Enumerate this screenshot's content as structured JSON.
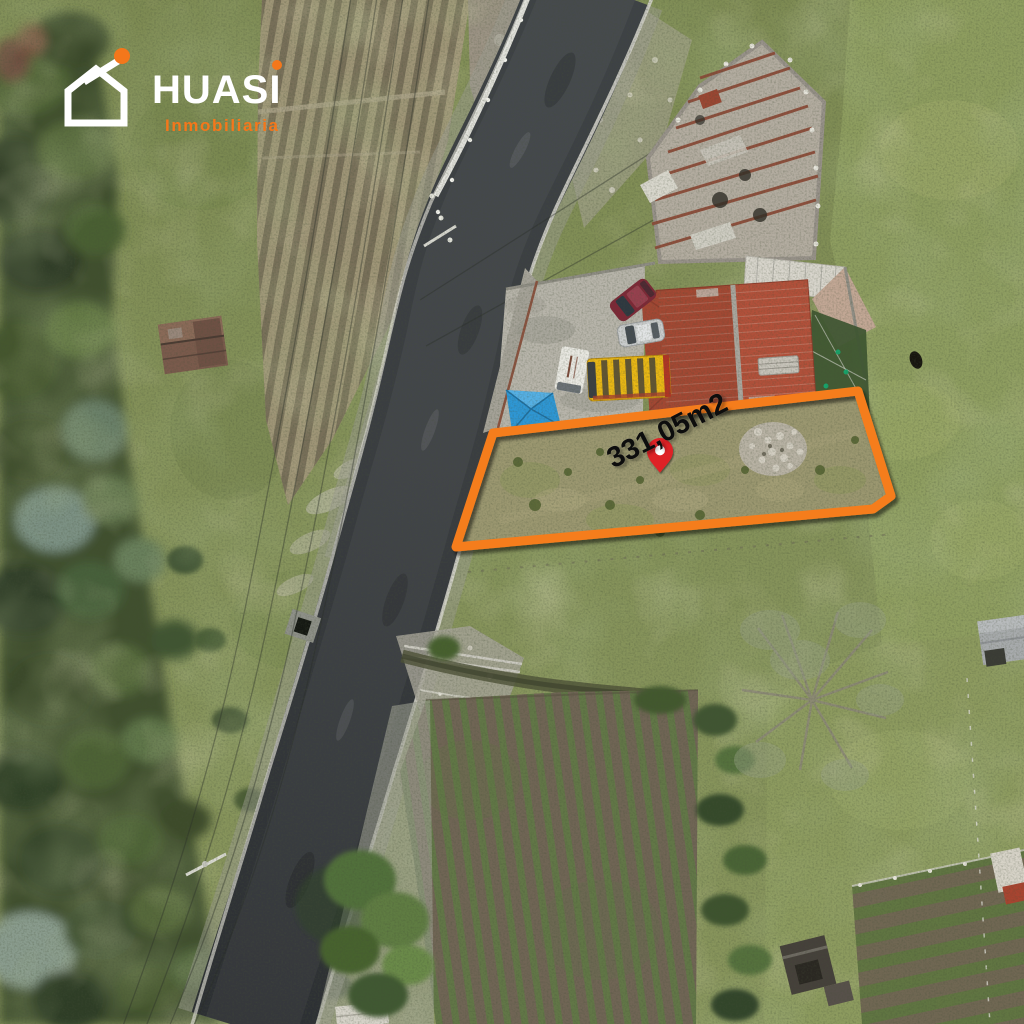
{
  "brand": {
    "name": "HUASI",
    "tagline": "Inmobiliaria",
    "accent_color": "#F4771B",
    "logo_color": "#FFFFFF"
  },
  "listing": {
    "area_label": "331,05m2"
  },
  "overlay": {
    "outline_color": "#F57D1C",
    "pin_color": "#DE2126",
    "label_color": "#0D0D0D"
  }
}
